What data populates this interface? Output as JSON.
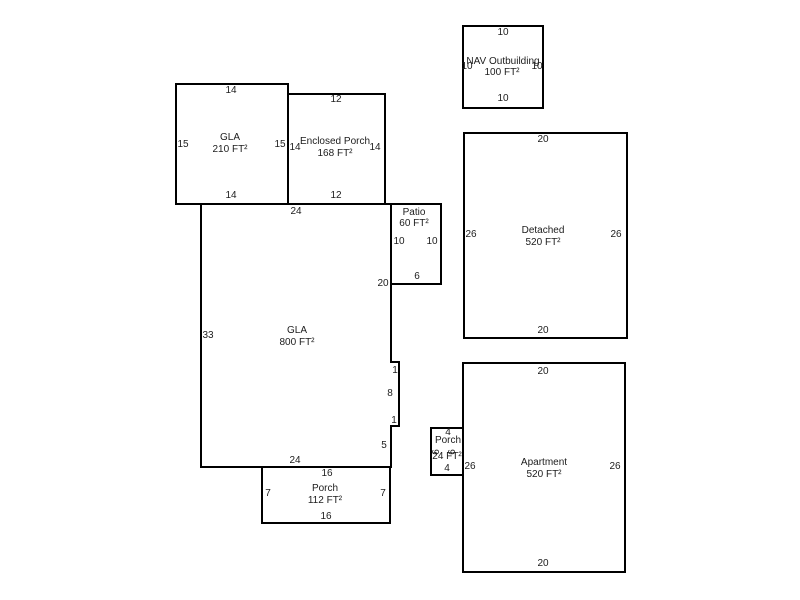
{
  "sketch": {
    "background_color": "#ffffff",
    "line_color": "#000000",
    "text_color": "#1c1c1c"
  },
  "buildings": [
    {
      "id": "nav-outbuilding",
      "label": "NAV Outbuilding",
      "area": "100 FT²",
      "dims": {
        "top": "10",
        "bottom": "10",
        "left": "10",
        "right": "10"
      }
    },
    {
      "id": "gla-210",
      "label": "GLA",
      "area": "210 FT²",
      "dims": {
        "top": "14",
        "bottom": "14",
        "left": "15",
        "right": "15"
      }
    },
    {
      "id": "enclosed-porch",
      "label": "Enclosed Porch",
      "area": "168 FT²",
      "dims": {
        "top": "12",
        "bottom": "12",
        "left": "14",
        "right": "14"
      }
    },
    {
      "id": "patio",
      "label": "Patio",
      "area": "60 FT²",
      "dims": {
        "left": "10",
        "right": "10",
        "bottom": "6"
      }
    },
    {
      "id": "gla-800",
      "label": "GLA",
      "area": "800 FT²",
      "dims": {
        "top": "24",
        "left": "33",
        "right_upper": "20",
        "notch_top": "1",
        "notch_side": "8",
        "notch_bottom": "1",
        "right_lower": "5",
        "bottom": "24"
      }
    },
    {
      "id": "porch-112",
      "label": "Porch",
      "area": "112 FT²",
      "dims": {
        "top": "16",
        "bottom": "16",
        "left": "7",
        "right": "7"
      }
    },
    {
      "id": "detached",
      "label": "Detached",
      "area": "520 FT²",
      "dims": {
        "top": "20",
        "bottom": "20",
        "left": "26",
        "right": "26"
      }
    },
    {
      "id": "porch-24",
      "label": "Porch",
      "area": "24 FT²",
      "dims": {
        "top": "4",
        "bottom": "4",
        "left": "6",
        "right": "6"
      }
    },
    {
      "id": "apartment",
      "label": "Apartment",
      "area": "520 FT²",
      "dims": {
        "top": "20",
        "bottom": "20",
        "left": "26",
        "right": "26"
      }
    }
  ]
}
